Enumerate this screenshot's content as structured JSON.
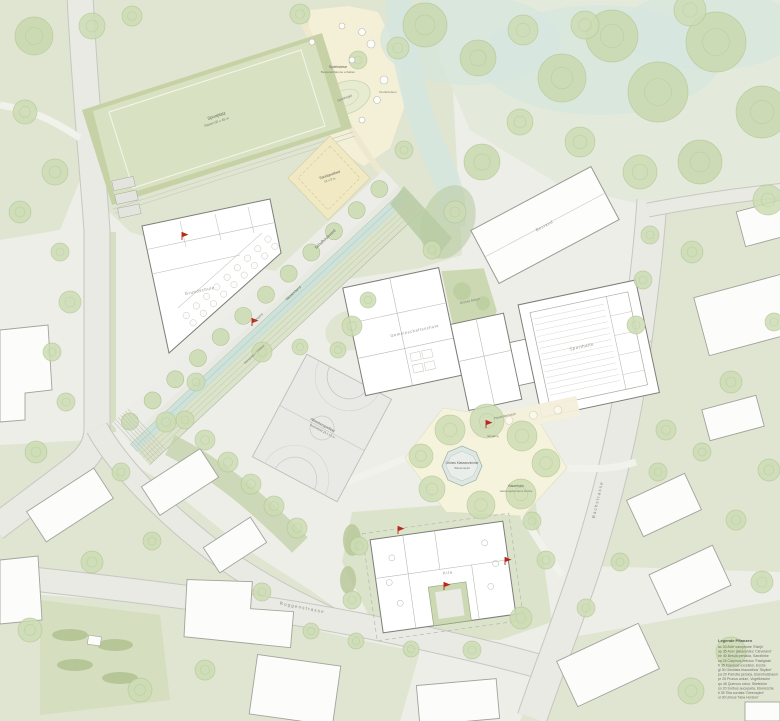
{
  "plan": {
    "labels": {
      "sports_field_1": "Sportplatz",
      "sports_field_2": "Rasen 90 x 45 m",
      "sand_field_1": "Sandspielfeld",
      "sand_field_2": "16 x 8 m",
      "meadow_1": "Spielwiese",
      "meadow_2": "Bestandsbäume erhalten",
      "hill": "Spielhügel",
      "boulders": "Kletterfelsen",
      "boulevard": "Schulboulevard",
      "water_band": "Wasserband",
      "seat_steps": "Sitzstufen / Tribüne",
      "court_1": "Allwetterspielfeld",
      "court_2": "Basketball 28 x 15 m",
      "octagon_1": "Grünes Klassenzimmer",
      "octagon_2": "Wasserspiel",
      "grove_1": "Baumhain",
      "grove_2": "wassergebundene Decke",
      "school_a": "Grundschule",
      "school_b": "Gemeinschaftsschule",
      "sports_hall": "Sporthalle",
      "kita": "Kita",
      "atrium": "Grünes Atrium",
      "terrace": "Pausenterrasse",
      "entrance": "Eingang",
      "existing": "Bestand"
    },
    "streets": {
      "bottom": "Roggenstrasse",
      "right": "Bachstrasse"
    },
    "legend": {
      "title": "Legende Pflanzen",
      "entries": [
        "ac 30  Acer campestre 'Elsrijk'",
        "ap 35  Acer platanoides 'Cleveland'",
        "be 40  Betula pendula, Sandbirke",
        "ca 25  Carpinus betulus 'Fastigiata'",
        "fr 35  Fraxinus excelsior, Esche",
        "gl 30  Gleditsia triacanthos 'Skyline'",
        "pa 20  Parrotia persica, Eisenholzbaum",
        "pr 25  Prunus avium, Vogelkirsche",
        "qu 45  Quercus robur, Stieleiche",
        "so 20  Sorbus aucuparia, Eberesche",
        "ti 35  Tilia cordata 'Greenspire'",
        "ul 30  Ulmus 'New Horizon'"
      ]
    },
    "colors": {
      "accent_red": "#b8281c",
      "water": "#cfe2da",
      "turf": "#d8e2c2",
      "track": "#c6d2a6",
      "sand": "#f0e9c4",
      "plaza": "#f6f3dd",
      "lawn": "#dfe5d0",
      "tree": "#ccdcb4"
    }
  }
}
